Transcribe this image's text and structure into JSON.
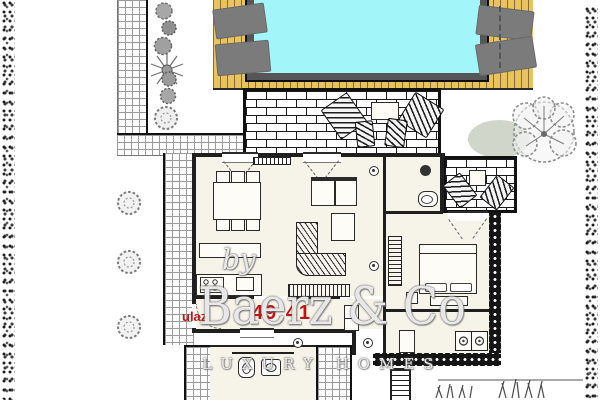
{
  "document": {
    "kind": "residential floor plan with garden and pool",
    "page_bg": "#ffffff"
  },
  "watermark": {
    "prefix": "by",
    "brand": "Baerz & Co",
    "tagline": "LUXURY HOMES"
  },
  "annotations": {
    "entrance_label": "ulaz",
    "entrance_area": "49,41",
    "label_color": "#c01414"
  },
  "palette": {
    "pool_water": "#a2f6fa",
    "pool_frame": "#565656",
    "deck_wood": "#e9c35f",
    "deck_plank_line": "#8a6c2c",
    "sun_lounger": "#7b7b7b",
    "wall": "#1f1f1f",
    "floor": "#f6f3e9",
    "tile_line": "#9a9a9a",
    "brick_line": "#1a1a1a",
    "hedge": "#3d3d3d",
    "tree_sketch": "#8f8f8f",
    "foliage_green": "#aab59d",
    "grass": "#4a4a4a"
  },
  "icons": [
    "swimming-pool",
    "wood-deck",
    "sun-lounger",
    "brick-terrace",
    "lounge-chair",
    "outdoor-table",
    "outdoor-chair",
    "tile-path",
    "hedge",
    "bush",
    "shrub",
    "spiky-plant",
    "tree",
    "grass-tuft",
    "dining-table",
    "dining-chair",
    "kitchen-counter",
    "stove",
    "kitchen-cabinet",
    "sofa",
    "coffee-table",
    "corner-sofa",
    "tv-sideboard",
    "radiator",
    "wall-lamp",
    "wardrobe",
    "double-bed",
    "pillow",
    "toilet",
    "washbasin",
    "washing-machine",
    "stairs",
    "door-swing",
    "window"
  ]
}
